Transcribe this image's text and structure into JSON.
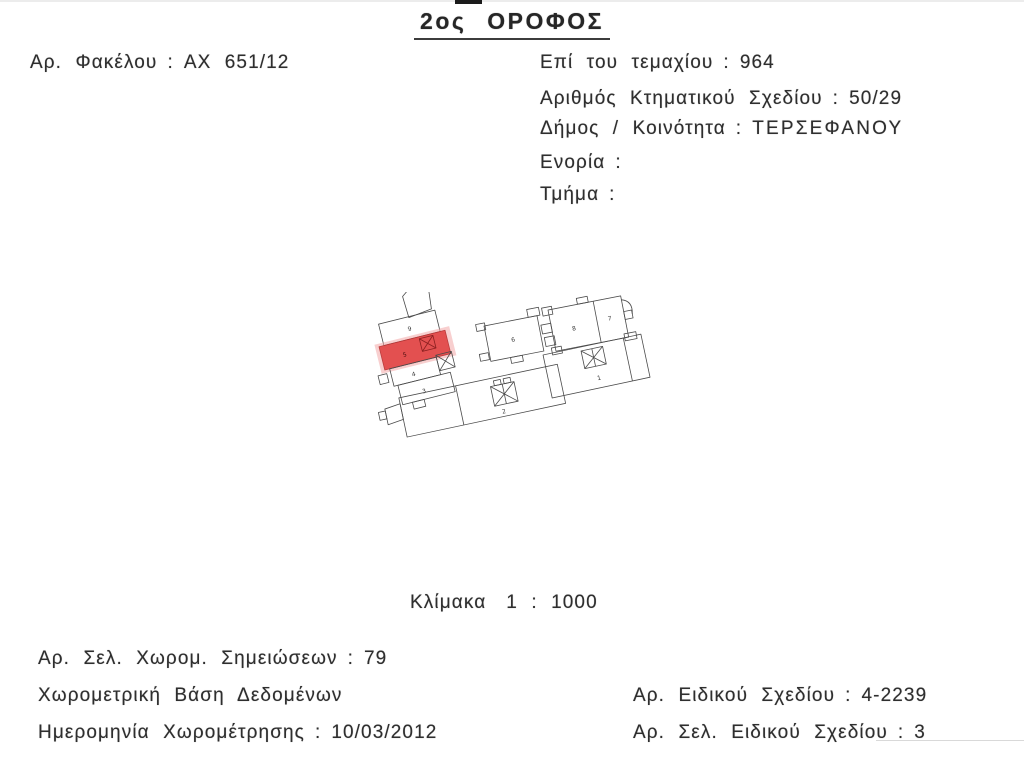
{
  "ui": {
    "colon": ":"
  },
  "document": {
    "title": "2ος ΟΡΟΦΟΣ",
    "file_number": {
      "label": "Αρ. Φακέλου",
      "value": "ΑΧ 651/12"
    },
    "plot": {
      "label": "Επί του τεμαχίου",
      "value": "964"
    },
    "cadastral_plan": {
      "label": "Αριθμός Κτηματικού Σχεδίου",
      "value": "50/29"
    },
    "municipality": {
      "label": "Δήμος / Κοινότητα",
      "value": "ΤΕΡΣΕΦΑΝΟΥ"
    },
    "parish": {
      "label": "Ενορία",
      "value": ""
    },
    "section": {
      "label": "Τμήμα",
      "value": ""
    },
    "scale": {
      "label": "Κλίμακα",
      "value": "1 : 1000"
    },
    "survey_notes_page": {
      "label": "Αρ. Σελ. Χωρομ. Σημειώσεων",
      "value": "79"
    },
    "survey_database": {
      "label": "Χωρομετρική Βάση Δεδομένων"
    },
    "survey_date": {
      "label": "Ημερομηνία Χωρομέτρησης",
      "value": "10/03/2012"
    },
    "special_plan_number": {
      "label": "Αρ. Ειδικού Σχεδίου",
      "value": "4-2239"
    },
    "special_plan_page": {
      "label": "Αρ. Σελ. Ειδικού Σχεδίου",
      "value": "3"
    }
  },
  "plan": {
    "highlighted_room": "5",
    "highlight_color": "#e03a3a",
    "highlight_glow_color": "#f2a7a7",
    "highlight_stroke": "#b02525",
    "line_color": "#4a4a4a",
    "rooms": {
      "r1": "1",
      "r2": "2",
      "r3": "3",
      "r4": "4",
      "r5": "5",
      "r6": "6",
      "r7": "7",
      "r8": "8",
      "r9": "9"
    }
  }
}
